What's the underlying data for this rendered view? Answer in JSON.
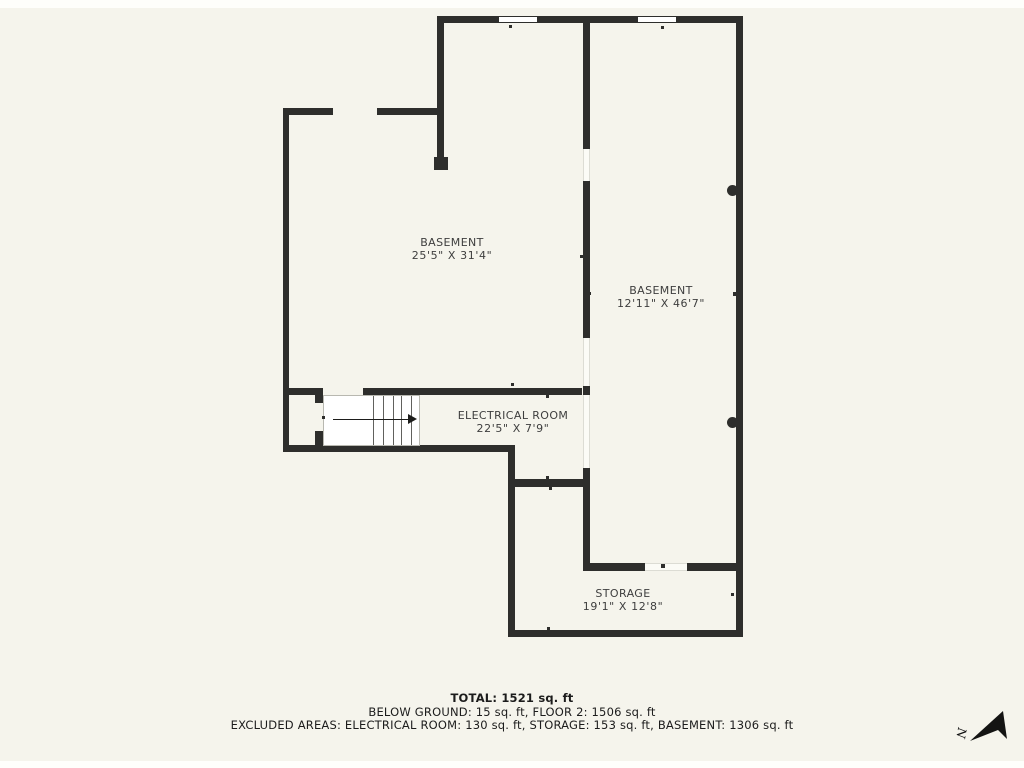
{
  "title": "Basement floor plan",
  "colors": {
    "background": "#f5f4ec",
    "wall": "#2e2e2c",
    "room_text": "#3e3e3e",
    "footer_text": "#1c1c1c"
  },
  "rooms": [
    {
      "name": "BASEMENT",
      "dimensions": "25'5\" X 31'4\""
    },
    {
      "name": "BASEMENT",
      "dimensions": "12'11\" X 46'7\""
    },
    {
      "name": "ELECTRICAL ROOM",
      "dimensions": "22'5\" X 7'9\""
    },
    {
      "name": "STORAGE",
      "dimensions": "19'1\" X 12'8\""
    }
  ],
  "summary": {
    "total": "TOTAL: 1521 sq. ft",
    "below_ground": "BELOW GROUND: 15 sq. ft, FLOOR 2: 1506 sq. ft",
    "excluded": "EXCLUDED AREAS: ELECTRICAL ROOM: 130 sq. ft, STORAGE: 153 sq. ft, BASEMENT: 1306 sq. ft"
  },
  "compass": {
    "label": "N"
  }
}
